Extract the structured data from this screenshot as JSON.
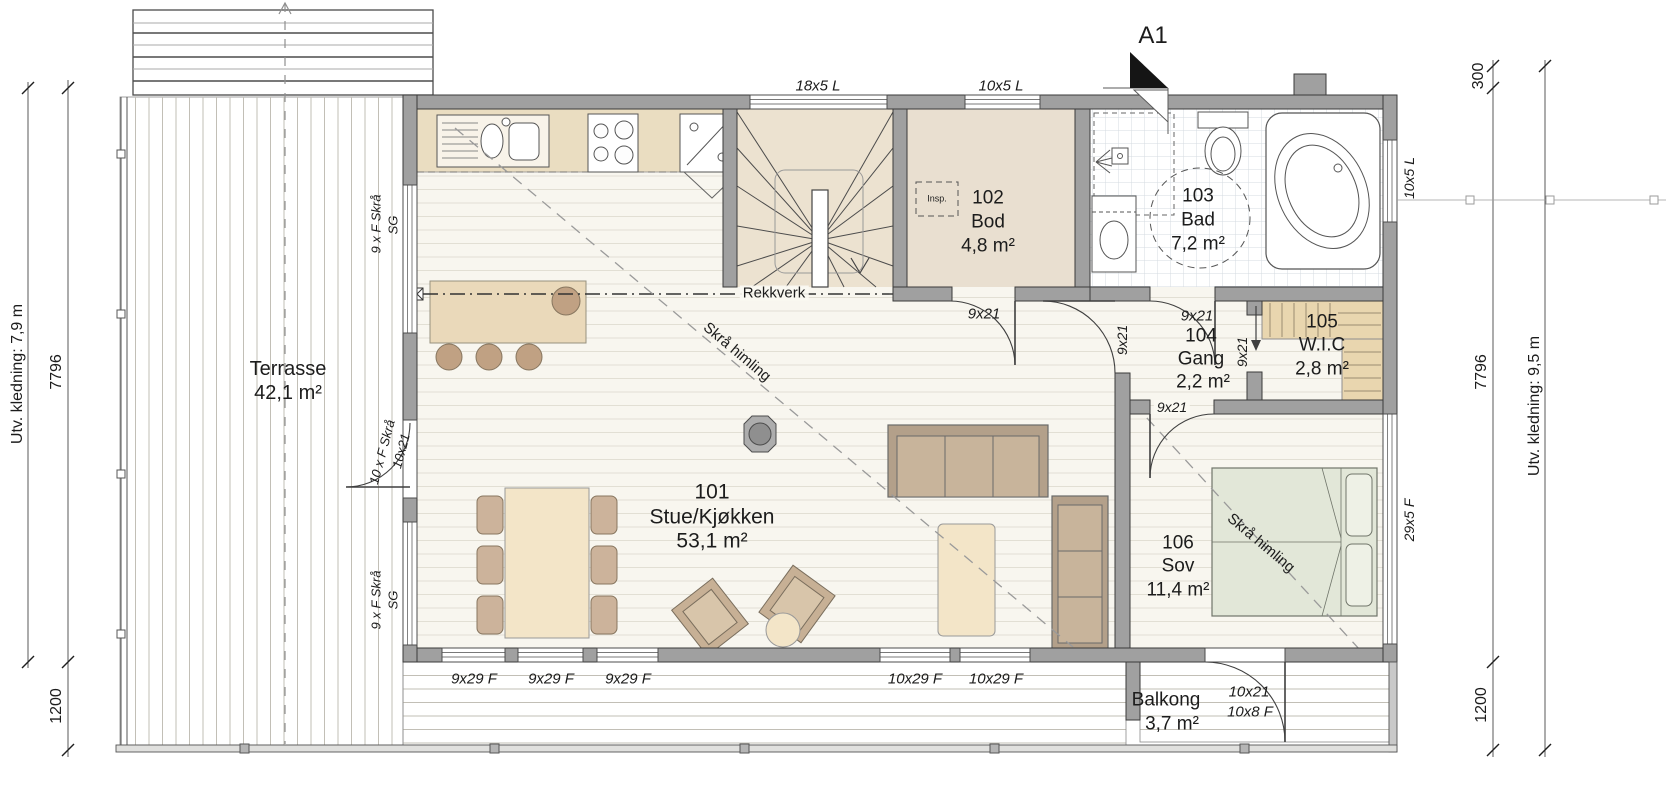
{
  "rooms": {
    "r101": {
      "number": "101",
      "name": "Stue/Kjøkken",
      "area": "53,1 m²"
    },
    "r102": {
      "number": "102",
      "name": "Bod",
      "area": "4,8 m²"
    },
    "r103": {
      "number": "103",
      "name": "Bad",
      "area": "7,2 m²"
    },
    "r104": {
      "number": "104",
      "name": "Gang",
      "area": "2,2 m²"
    },
    "r105": {
      "number": "105",
      "name": "W.I.C",
      "area": "2,8 m²"
    },
    "r106": {
      "number": "106",
      "name": "Sov",
      "area": "11,4 m²"
    },
    "terrace": {
      "name": "Terrasse",
      "area": "42,1 m²"
    },
    "balcony": {
      "name": "Balkong",
      "area": "3,7 m²"
    }
  },
  "annotations": {
    "railing": "Rekkverk",
    "sloped_ceiling": "Skrå himling",
    "inspection": "Insp.",
    "section_marker": "A1"
  },
  "openings": {
    "window_top_left": "18x5 L",
    "window_top_right": "10x5 L",
    "window_right_bath": "10x5 L",
    "window_right_bedroom": "29x5 F",
    "window_bottom_living": "9x29 F",
    "window_bottom_living2": "10x29 F",
    "door_interior": "9x21",
    "door_terrace_label1": "10 x F Skrå",
    "door_terrace_label2": "10x21",
    "door_balcony_label1": "10x21",
    "door_balcony_label2": "10x8 F",
    "window_left_fixed": "9 x F Skrå",
    "window_left_sg": "SG"
  },
  "dimensions": {
    "left_cladding": "Utv. kledning: 7,9 m",
    "left_height": "7796",
    "left_offset": "1200",
    "right_top_offset": "300",
    "right_height": "7796",
    "right_offset": "1200",
    "right_cladding": "Utv. kledning: 9,5 m"
  }
}
